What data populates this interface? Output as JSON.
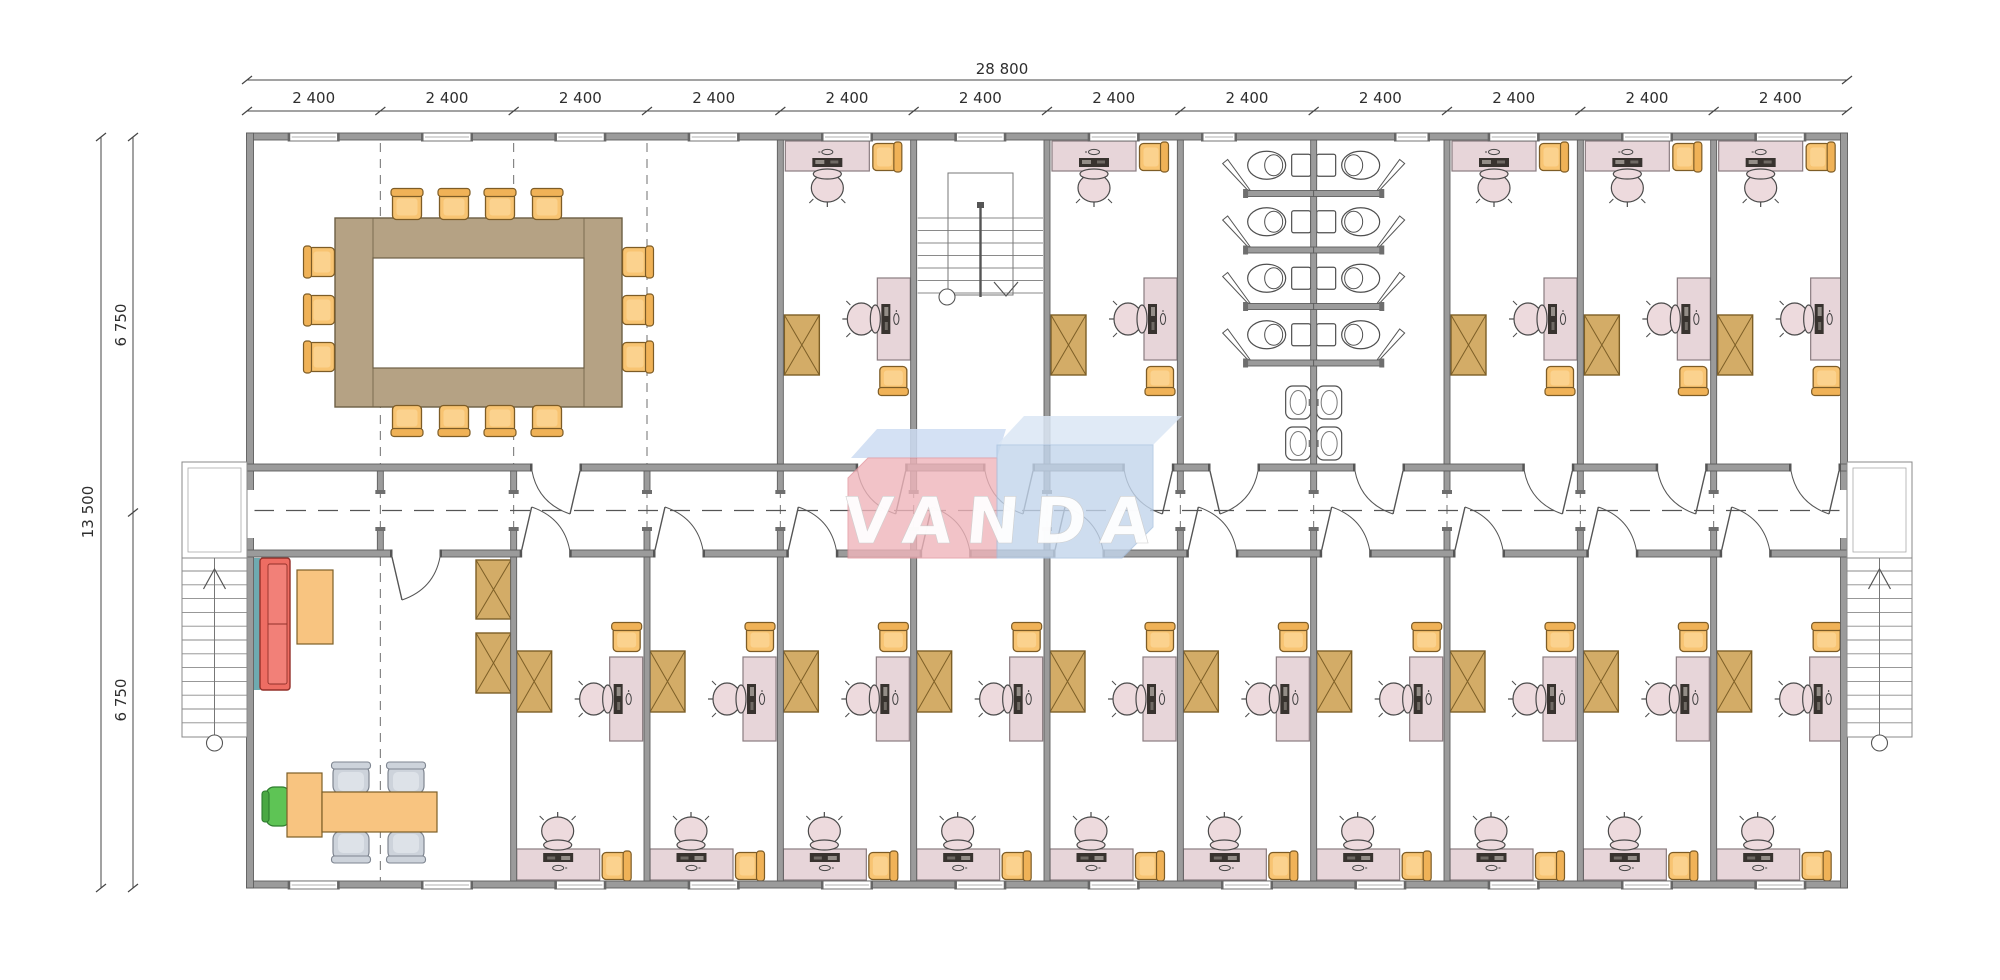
{
  "page": {
    "background": "#ffffff"
  },
  "dimensions": {
    "top_total_label": "28 800",
    "bay_labels": [
      "2 400",
      "2 400",
      "2 400",
      "2 400",
      "2 400",
      "2 400",
      "2 400",
      "2 400",
      "2 400",
      "2 400",
      "2 400",
      "2 400"
    ],
    "left_total_label": "13 500",
    "left_half_labels": [
      "6 750",
      "6 750"
    ]
  },
  "logo": {
    "text": "VANDA",
    "red_face": "#efb5bb",
    "red_bevel": "#cddcf2",
    "blue_face": "#c2d5ec",
    "blue_bevel": "#dae6f5",
    "text_color": "#ffffff"
  },
  "colors": {
    "wall_fill": "#9b9b9b",
    "wall_edge": "#5e5e5e",
    "line": "#555555",
    "dash": "#6f6f6f",
    "dim_text": "#2e2e2e",
    "desk": "#e7d5d9",
    "desk_edge": "#8a7c80",
    "task_chair": "#eddadd",
    "monitor": "#38332f",
    "chair_orange": "#f8c472",
    "chair_orange_back": "#f0b257",
    "chair_orange_edge": "#7d5c26",
    "cabinet": "#d3ac67",
    "cabinet_edge": "#7d5f27",
    "table": "#b5a284",
    "table_edge": "#6d5f45",
    "sofa": "#ee6d63",
    "sofa_edge": "#93302a",
    "teal": "#6faab0",
    "desk_group": "#f8c480",
    "chair_green": "#5ec455",
    "chair_green_edge": "#2f7d2f",
    "chair_gray": "#cdd3db",
    "chair_gray_inner": "#dde2e8",
    "chair_gray_edge": "#7e8590",
    "stair_line": "#8a8a8a",
    "fixture": "#ffffff",
    "fixture_edge": "#4f4f4f"
  }
}
